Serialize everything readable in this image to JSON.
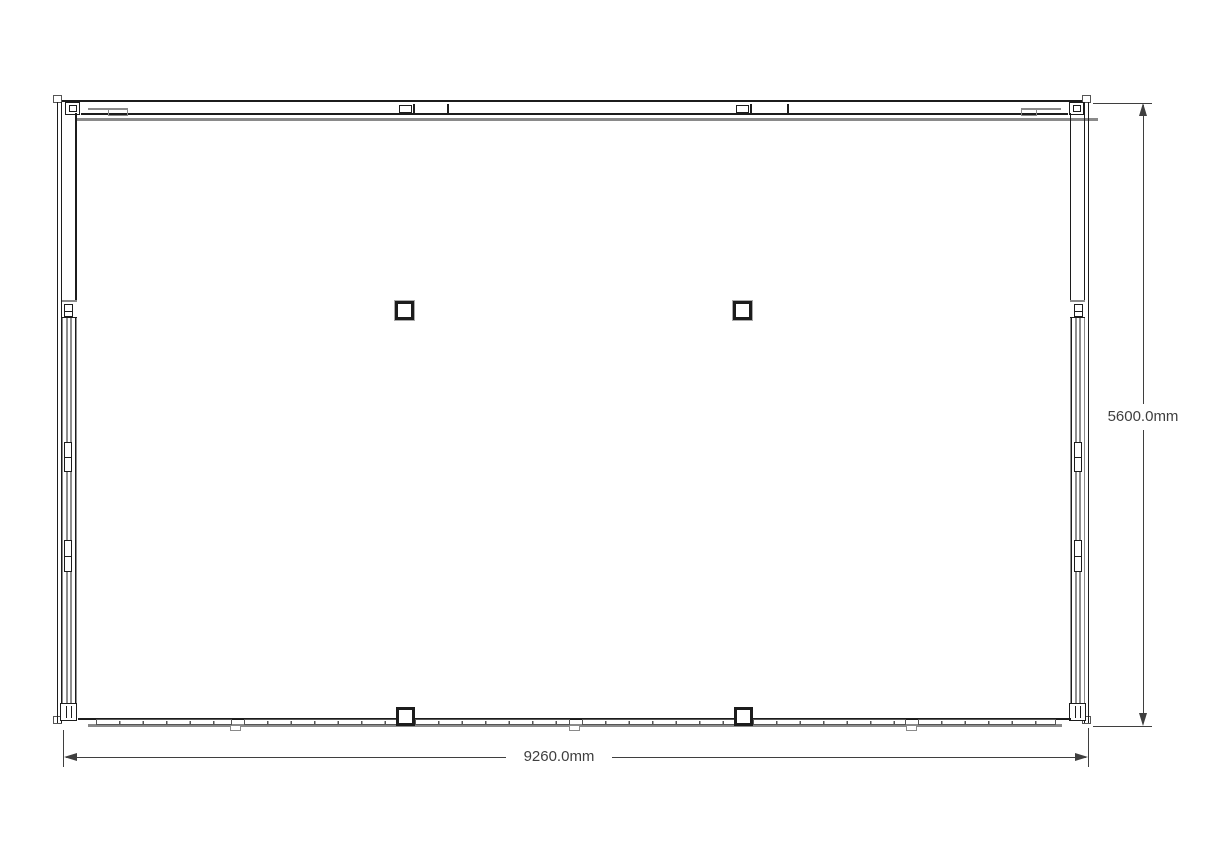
{
  "drawing": {
    "dimensions": {
      "width": {
        "label": "9260.0mm",
        "value_mm": 9260.0
      },
      "height": {
        "label": "5600.0mm",
        "value_mm": 5600.0
      }
    },
    "colors": {
      "line-black": "#1c1c1c",
      "line-gray": "#8a8a8a",
      "line-mid": "#555555",
      "dim": "#3f3f3f",
      "background": "#ffffff"
    }
  }
}
